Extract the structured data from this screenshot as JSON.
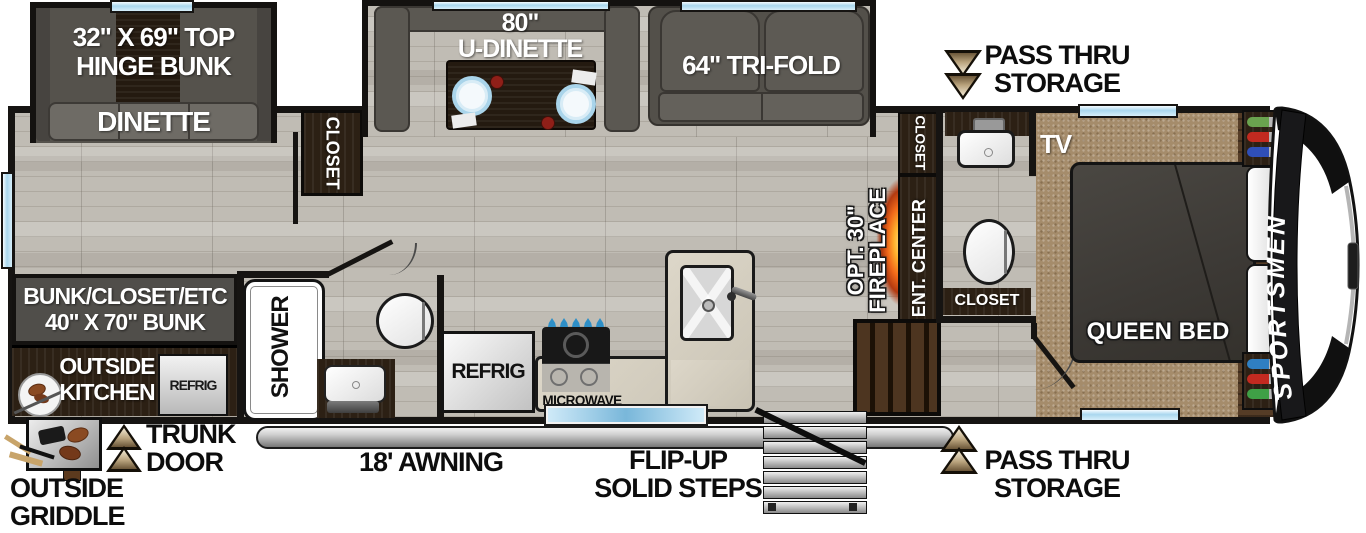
{
  "floorplan": {
    "brand": "SPORTSMEN",
    "bunk_slide": {
      "line1": "32\" X 69\" TOP",
      "line2": "HINGE BUNK",
      "seat": "DINETTE"
    },
    "dinette": {
      "size": "80\"",
      "name": "U-DINETTE"
    },
    "sofa": {
      "name": "64\" TRI-FOLD"
    },
    "storage": {
      "top_line1": "PASS THRU",
      "top_line2": "STORAGE",
      "bottom_line1": "PASS THRU",
      "bottom_line2": "STORAGE",
      "trunk_line1": "TRUNK",
      "trunk_line2": "DOOR"
    },
    "closets": {
      "top": "CLOSET",
      "hall": "CLOSET",
      "bath": "CLOSET"
    },
    "media": {
      "ent_center": "ENT. CENTER",
      "fireplace_line1": "OPT. 30\"",
      "fireplace_line2": "FIREPLACE",
      "tv": "TV"
    },
    "bedroom": {
      "bed": "QUEEN BED"
    },
    "bath": {
      "shower": "SHOWER"
    },
    "kitchen": {
      "refrig": "REFRIG",
      "microwave": "MICROWAVE"
    },
    "rear": {
      "bunk_line1": "BUNK/CLOSET/ETC",
      "bunk_line2": "40\" X 70\" BUNK",
      "ok_line1": "OUTSIDE",
      "ok_line2": "KITCHEN",
      "refrig": "REFRIG"
    },
    "exterior": {
      "awning": "18' AWNING",
      "steps_line1": "FLIP-UP",
      "steps_line2": "SOLID STEPS",
      "griddle_line1": "OUTSIDE",
      "griddle_line2": "GRIDDLE"
    },
    "colors": {
      "wall": "#161412",
      "floor": "#c0bcb4",
      "carpet": "#a58c6b",
      "dark_wood": "#2c2014",
      "sofa_gray": "#56534d",
      "window_blue": "#a9d7ee",
      "awning_gray": "#c7c7c7",
      "fireplace_orange": "#ee7a1d",
      "arrow_bronze": "#a08a65",
      "paddle_green": "#6aa34f",
      "paddle_red": "#c22a20",
      "paddle_blue": "#2f4fb8",
      "door_blue": "#79b7da"
    },
    "icons": {
      "pass_thru_top": "double-down-arrow-icon",
      "pass_thru_bottom": "double-up-arrow-icon",
      "trunk": "double-up-arrow-icon",
      "griddle": "griddle-icon",
      "outside_kitchen": "plate-utensils-icon",
      "fireplace": "flame-glow-icon"
    }
  }
}
